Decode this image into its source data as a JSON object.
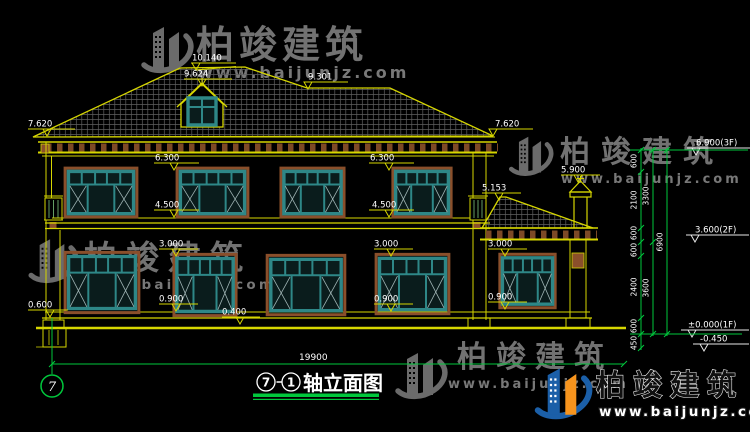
{
  "watermark": {
    "brand": "柏竣建筑",
    "url": "www.baijunjz.com"
  },
  "title": {
    "axis_left": "7",
    "axis_right": "1",
    "label": "轴立面图"
  },
  "axis_bubble": {
    "label": "7"
  },
  "dims": {
    "total_width": "19900",
    "ridge": "10.140",
    "dormer": "9.624",
    "rear_ridge": "9.301",
    "eave_left": "7.620",
    "eave_right": "7.620",
    "f2_head": "6.300",
    "f2_sill": "4.500",
    "chimney": "5.900",
    "annex_eave": "5.153",
    "f1_head": "3.000",
    "f1_sill": "0.900",
    "low_sill": "0.400",
    "plinth": "0.600"
  },
  "levels": {
    "f3": "6.900(3F)",
    "f2": "3.600(2F)",
    "f1": "±0.000(1F)",
    "base": "-0.450"
  },
  "vchain": {
    "s600": "600",
    "s2100": "2100",
    "s2400": "2400",
    "s450": "450",
    "t3300": "3300",
    "t3600": "3600",
    "t6900": "6900"
  },
  "colors": {
    "line_yellow": "#d6d600",
    "window_teal": "#2e8787",
    "surround_brown": "#8a4f2b",
    "dim_green": "#00c83c",
    "logo_blue": "#1b5fa8",
    "logo_orange": "#f7941d"
  }
}
